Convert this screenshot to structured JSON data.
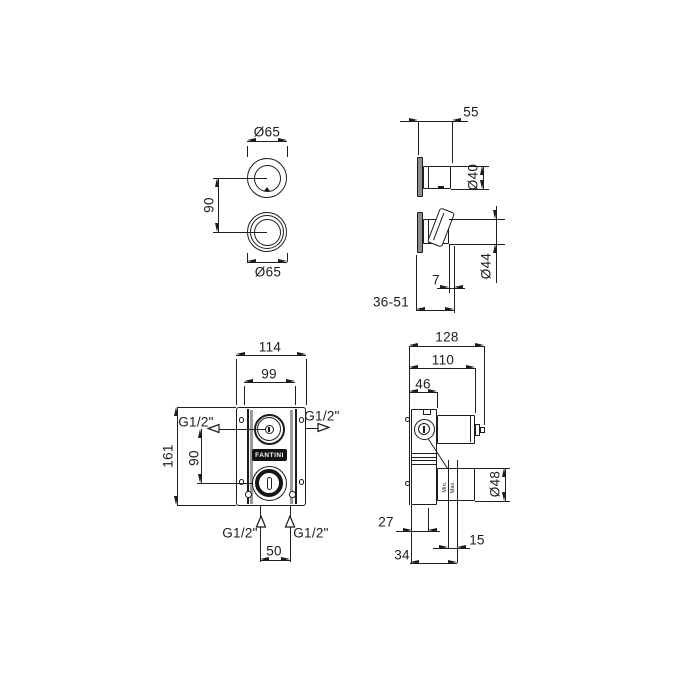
{
  "drawing": {
    "brand": "FANTINI",
    "colors": {
      "line": "#1c1c1c",
      "wall_fill": "#8e8e8e",
      "logo_bg": "#121212"
    }
  },
  "labels": {
    "trim_front": {
      "d65_top": "Ø65",
      "centers": "90",
      "d65_bottom": "Ø65"
    },
    "trim_side": {
      "depth": "55",
      "d40": "Ø40",
      "d44": "Ø44",
      "gap": "7",
      "range": "36-51"
    },
    "valve_front": {
      "width_outer": "114",
      "width_plate": "99",
      "height": "161",
      "centers": "90",
      "port_spacing": "50",
      "port_left": "G1/2\"",
      "port_right": "G1/2\"",
      "port_bottom_left": "G1/2\"",
      "port_bottom_right": "G1/2\"",
      "brand": "FANTINI"
    },
    "valve_side": {
      "depth_total": "128",
      "depth_body": "110",
      "depth_box": "46",
      "d48": "Ø48",
      "dim_27": "27",
      "dim_15": "15",
      "dim_34": "34",
      "min": "Min.",
      "max": "Max."
    }
  }
}
